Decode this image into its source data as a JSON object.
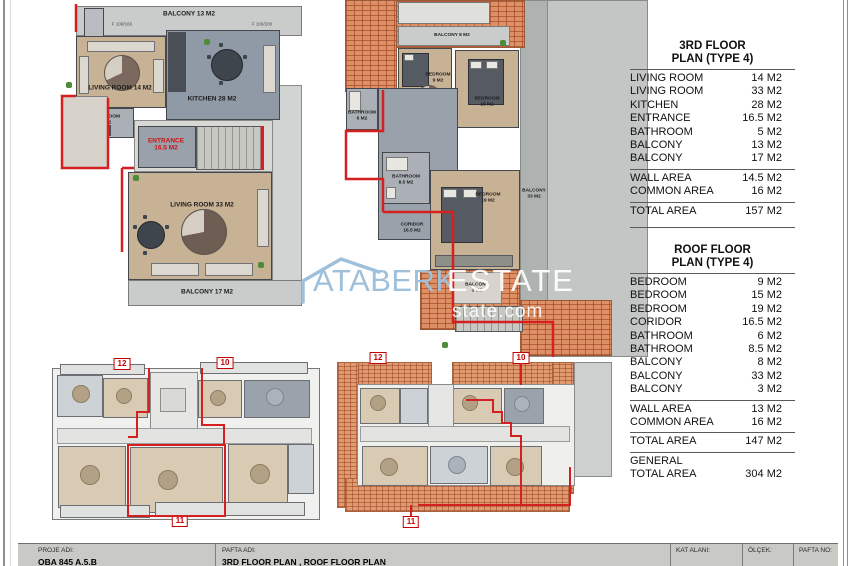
{
  "watermark": {
    "brand": "ATABERK",
    "brand2": "ESTATE",
    "domain": "state.com"
  },
  "plan_3rd": {
    "balcony_top": "BALCONY 13 M2",
    "dim_left": "F 100/160",
    "dim_right": "F 100/200",
    "living14": "LIVING ROOM 14 M2",
    "kitchen": "KITCHEN 28 M2",
    "bathroom_l1": "BATHROOM",
    "bathroom_l2": "5 M2",
    "entrance_l1": "ENTRANCE",
    "entrance_l2": "16.5 M2",
    "living33": "LIVING ROOM 33 M2",
    "balcony_bottom": "BALCONY 17 M2"
  },
  "plan_roof": {
    "balcony8": "BALCONY 8 M2",
    "bedroom9_l1": "BEDROOM",
    "bedroom9_l2": "9 M2",
    "bedroom15_l1": "BEDROOM",
    "bedroom15_l2": "15 M2",
    "bathroom6_l1": "BATHROOM",
    "bathroom6_l2": "6 M2",
    "coridor_l1": "CORIDOR",
    "coridor_l2": "16.5 M2",
    "bathroom85_l1": "BATHROOM",
    "bathroom85_l2": "8.5 M2",
    "bedroom19_l1": "BEDROOM",
    "bedroom19_l2": "19 M2",
    "balcony33_l1": "BALCONY",
    "balcony33_l2": "33 M2",
    "balcony3_l1": "BALCONY",
    "balcony3_l2": "3 M2"
  },
  "overview_3rd": {
    "badges": [
      "12",
      "10",
      "11"
    ]
  },
  "overview_roof": {
    "badges": [
      "12",
      "10",
      "11"
    ]
  },
  "tables": {
    "floor3": {
      "title_line1": "3RD FLOOR",
      "title_line2": "PLAN (TYPE 4)",
      "rows": [
        {
          "label": "LIVING ROOM",
          "value": "14 M2"
        },
        {
          "label": "LIVING ROOM",
          "value": "33 M2"
        },
        {
          "label": "KITCHEN",
          "value": "28 M2"
        },
        {
          "label": "ENTRANCE",
          "value": "16.5 M2"
        },
        {
          "label": "BATHROOM",
          "value": "5 M2"
        },
        {
          "label": "BALCONY",
          "value": "13 M2"
        },
        {
          "label": "BALCONY",
          "value": "17 M2"
        }
      ],
      "summary": [
        {
          "label": "WALL AREA",
          "value": "14.5 M2"
        },
        {
          "label": "COMMON AREA",
          "value": "16 M2"
        }
      ],
      "total": {
        "label": "TOTAL AREA",
        "value": "157 M2"
      }
    },
    "roof": {
      "title_line1": "ROOF FLOOR",
      "title_line2": "PLAN (TYPE 4)",
      "rows": [
        {
          "label": "BEDROOM",
          "value": "9 M2"
        },
        {
          "label": "BEDROOM",
          "value": "15 M2"
        },
        {
          "label": "BEDROOM",
          "value": "19 M2"
        },
        {
          "label": "CORIDOR",
          "value": "16.5 M2"
        },
        {
          "label": "BATHROOM",
          "value": "6 M2"
        },
        {
          "label": "BATHROOM",
          "value": "8.5 M2"
        },
        {
          "label": "BALCONY",
          "value": "8 M2"
        },
        {
          "label": "BALCONY",
          "value": "33 M2"
        },
        {
          "label": "BALCONY",
          "value": "3 M2"
        }
      ],
      "summary": [
        {
          "label": "WALL AREA",
          "value": "13 M2"
        },
        {
          "label": "COMMON AREA",
          "value": "16 M2"
        }
      ],
      "total": {
        "label": "TOTAL AREA",
        "value": "147 M2"
      },
      "general_label": "GENERAL",
      "general_total": {
        "label": "TOTAL AREA",
        "value": "304 M2"
      }
    }
  },
  "title_block": {
    "proje_adi_label": "PROJE ADI:",
    "proje_adi_value": "OBA 845 A.5.B",
    "pafta_adi_label": "PAFTA ADI:",
    "pafta_adi_value": "3RD FLOOR PLAN , ROOF FLOOR PLAN",
    "kat_alani_label": "KAT ALANI:",
    "olcek_label": "ÖLÇEK:",
    "pafta_no_label": "PAFTA NO:"
  }
}
